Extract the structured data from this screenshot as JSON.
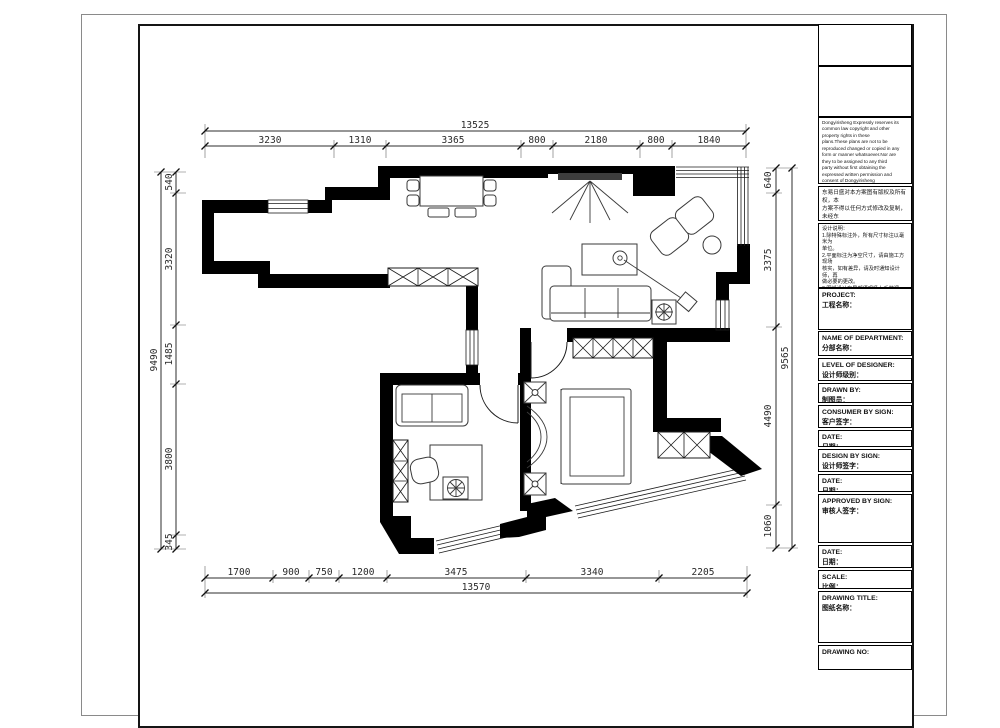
{
  "dims": {
    "top": {
      "total": "13525",
      "segments": [
        "3230",
        "1310",
        "3365",
        "800",
        "2180",
        "800",
        "1840"
      ]
    },
    "bottom": {
      "total": "13570",
      "segments": [
        "1700",
        "900",
        "750",
        "1200",
        "3475",
        "3340",
        "2205"
      ]
    },
    "left": {
      "total": "9490",
      "segments": [
        "540",
        "3320",
        "1485",
        "3800",
        "345"
      ]
    },
    "right": {
      "total": "9565",
      "segments": [
        "640",
        "3375",
        "4490",
        "1060"
      ]
    }
  },
  "title_block": {
    "copyright_en": "Dongyirisheng Expressly reserves its\ncommon law copyright and other\nproperty rights in these\nplans.These plans are not to be\nreproduced changed or copied in any\nform or manner whatsoever.Nor are\nthey to be assigned to any third\nparty without first obtaining the\nexpressed written permission and\nconsent of Dongyirisheng",
    "copyright_cn": "东易日盛对本方案图有版权及所有权，本\n方案不得以任何方式修改及复制，未经东\n易日盛书面授权，本方案不得向任何第三\n方转让。",
    "notes": "设计说明：\n1.除特殊标注外，所有尺寸标注以毫米为\n单位。\n2.平面标注为净空尺寸，请由施工方现场\n核实，如有差异，请及时通知设计师，再\n做必要的更改。\n3.图纸设计有局部须现场上手做调整，如\n有变化，会另行说明。\n4.该图纸为施工图纸，双方（客户和设计\n师）签字认可后，方可依照施工。",
    "rows": [
      {
        "en": "PROJECT:",
        "cn": "工程名称："
      },
      {
        "en": "NAME OF DEPARTMENT:",
        "cn": "分部名称："
      },
      {
        "en": "LEVEL OF DESIGNER:",
        "cn": "设计师级别："
      },
      {
        "en": "DRAWN BY:",
        "cn": "制图员："
      },
      {
        "en": "CONSUMER BY SIGN:",
        "cn": "客户签字："
      },
      {
        "en": "DATE:",
        "cn": "日期："
      },
      {
        "en": "DESIGN BY SIGN:",
        "cn": "设计师签字："
      },
      {
        "en": "DATE:",
        "cn": "日期："
      },
      {
        "en": "APPROVED BY SIGN:",
        "cn": "审核人签字："
      },
      {
        "en": "DATE:",
        "cn": "日期："
      },
      {
        "en": "SCALE:",
        "cn": "比例："
      },
      {
        "en": "DRAWING TITLE:",
        "cn": "图纸名称："
      },
      {
        "en": "DRAWING NO:",
        "cn": ""
      }
    ]
  },
  "colors": {
    "wall": "#000000",
    "dim_text": "#2a2a2a",
    "frame": "#151515"
  }
}
